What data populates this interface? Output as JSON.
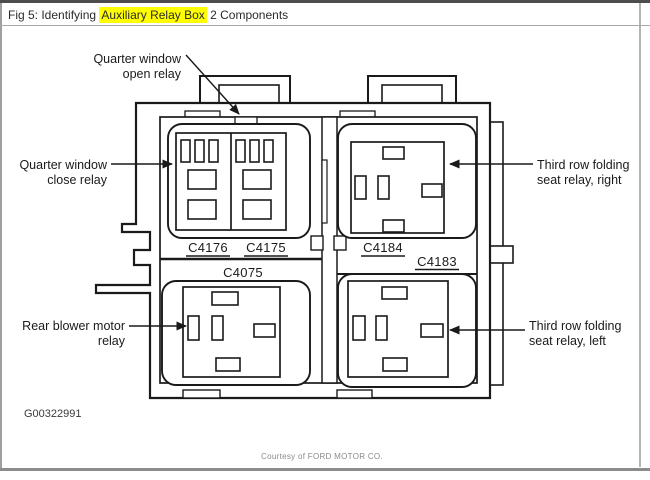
{
  "header": {
    "prefix": "Fig 5: Identifying ",
    "highlight": "Auxiliary Relay Box",
    "suffix": " 2 Components"
  },
  "callouts": {
    "quarter_open": {
      "lines": [
        "Quarter window",
        "open relay"
      ]
    },
    "quarter_close": {
      "lines": [
        "Quarter window",
        "close relay"
      ]
    },
    "third_right": {
      "lines": [
        "Third row folding",
        "seat relay, right"
      ]
    },
    "third_left": {
      "lines": [
        "Third row folding",
        "seat relay, left"
      ]
    },
    "rear_blower": {
      "lines": [
        "Rear blower motor",
        "relay"
      ]
    }
  },
  "connectors": {
    "c4176": "C4176",
    "c4175": "C4175",
    "c4184": "C4184",
    "c4183": "C4183",
    "c4075": "C4075"
  },
  "figure_id": "G00322991",
  "courtesy": "Courtesy of FORD MOTOR CO.",
  "colors": {
    "highlight": "#ffff00",
    "line": "#1a1a1a",
    "courtesy_text": "#8a8a8a"
  }
}
